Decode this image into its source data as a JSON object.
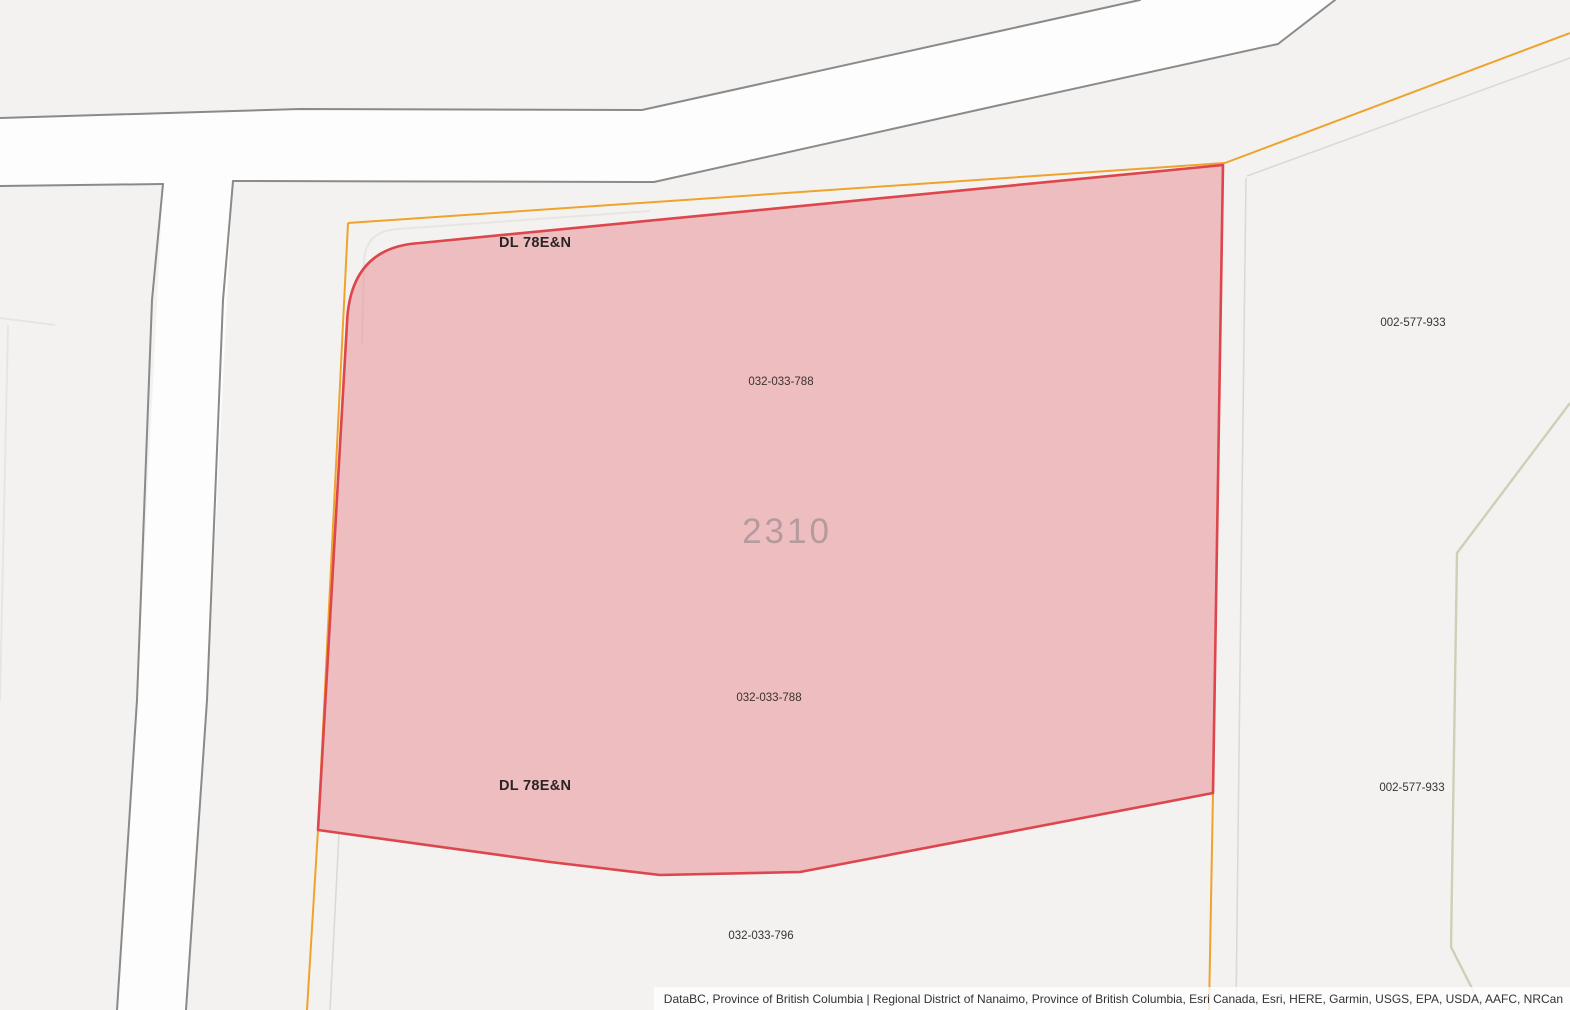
{
  "map": {
    "description": "Cadastral parcel map with one selected parcel highlighted",
    "selected_parcel": {
      "parcel_number": "2310",
      "pid": "032-033-788",
      "district_lot": "DL 78E&N"
    },
    "labels": {
      "dl_top": "DL 78E&N",
      "pid_top": "032-033-788",
      "parcel_number": "2310",
      "pid_bottom": "032-033-788",
      "dl_bottom": "DL 78E&N",
      "pid_south": "032-033-796",
      "pid_east_top": "002-577-933",
      "pid_east_bottom": "002-577-933"
    },
    "colors": {
      "background": "#f3f2f0",
      "road_fill": "#fdfdfd",
      "road_casing": "#8a8a8a",
      "selected_parcel_fill": "#f2c9ca",
      "selected_parcel_outline": "#dc464c",
      "boundary_orange": "#efa32d",
      "boundary_faint_gray": "#dcd9d5",
      "boundary_olive": "#d0cfb6",
      "parcel_number_text": "#b59a9e",
      "label_text": "#3a3330"
    }
  },
  "attribution": {
    "text": "DataBC, Province of British Columbia | Regional District of Nanaimo, Province of British Columbia, Esri Canada, Esri, HERE, Garmin, USGS, EPA, USDA, AAFC, NRCan"
  }
}
